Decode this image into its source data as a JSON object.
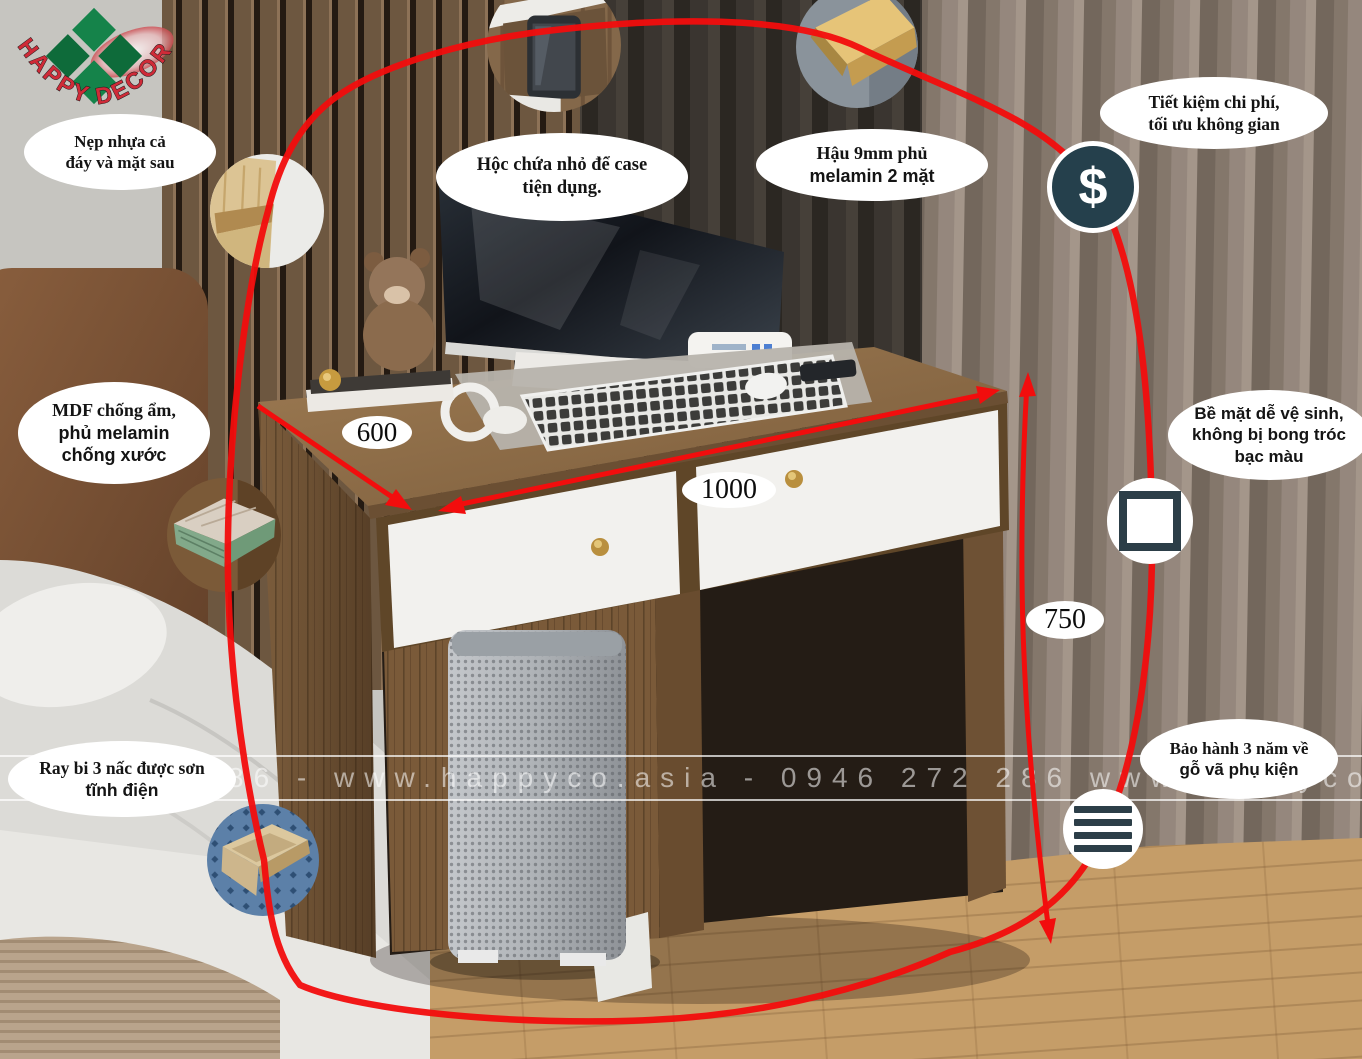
{
  "brand": {
    "logo_text": "HAPPY DECOR"
  },
  "watermark": {
    "text": "86 - www.happyco.asia - 0946 272 286 www.happyco.asia"
  },
  "dimensions": {
    "depth": "600",
    "width": "1000",
    "height": "750"
  },
  "callouts": [
    {
      "lines": [
        "Nẹp nhựa cả",
        "đáy và mặt sau"
      ]
    },
    {
      "lines": [
        "Hộc chứa nhỏ để case",
        "tiện dụng."
      ]
    },
    {
      "lines": [
        "Hậu 9mm phủ",
        "melamin 2 mặt"
      ]
    },
    {
      "lines": [
        "Tiết kiệm chi phí,",
        "tối ưu không gian"
      ]
    },
    {
      "lines": [
        "MDF chống ẩm,",
        "phủ melamin",
        "chống xước"
      ]
    },
    {
      "lines": [
        "Bề mặt dễ vệ sinh,",
        "không bị bong tróc",
        "bạc màu"
      ]
    },
    {
      "lines": [
        "Ray bi 3 nấc được sơn",
        "tĩnh điện"
      ]
    },
    {
      "lines": [
        "Bảo hành 3 năm về",
        "gỗ vã phụ kiện"
      ]
    }
  ],
  "icons": [
    {
      "name": "dollar-icon",
      "glyph": "$"
    },
    {
      "name": "square-icon"
    },
    {
      "name": "lines-icon"
    }
  ],
  "colors": {
    "accent_red": "#f20d0d",
    "icon_navy": "#25404c",
    "logo_green": "#15834a",
    "logo_red": "#cf2b38",
    "callout_bg": "#ffffff"
  }
}
